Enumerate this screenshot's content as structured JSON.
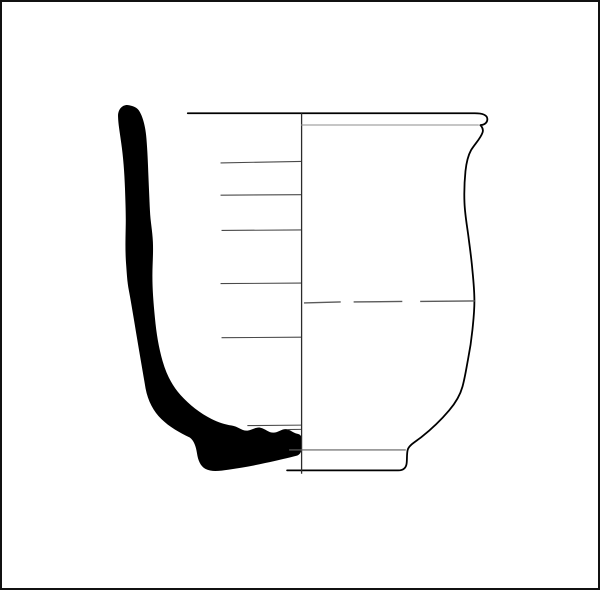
{
  "figure": {
    "type": "archaeological-vessel-profile-drawing",
    "description": "Technical ceramic illustration: solid black half-section on the left, exterior elevation of the pot on the right, divided by a vertical center axis. Vessel has a slightly everted rounded rim, gently convex body, and a narrow projecting foot.",
    "background_color": "#ffffff",
    "frame_color": "#111111",
    "ink_color": "#000000",
    "guide_line_color": "#4a4a4a",
    "dashed_line_color": "#5a5a5a"
  },
  "drawing": {
    "viewbox": "0 0 600 590",
    "section_profile_path": "M128,104 C122,102.5 116.5,107.5 116.8,115.5 C117,123 118.6,131.5 120,142 C122,156 123.2,171 123.8,188 C124.3,203 124.8,214 124.5,227 C124.2,242 124,252 125,265 C125.8,276 126.2,283 127.8,291 C130.4,305 133,321 136,339 C139,357 141.5,371 144.5,389 C147,402 152.5,412 160.5,420 C168.5,427.8 178.5,433.5 189,438.5 C193.2,441.5 195.3,447.5 196.3,454.5 C197.3,461.5 199.8,467.5 205,470.2 C211,473.3 218.5,472.3 228.5,470.8 C240.5,469 252.5,467 265,464.2 C277,461.5 289,458.7 296.5,456.8 C299.8,455.9 301.5,453.2 301.5,449.5 L301.5,439.5 C301.5,436.8 300.2,435.2 297.2,434.7 C293.2,434.1 290.2,430.6 286.2,430.1 C281.7,429.6 278.2,433.6 273.2,433.6 C268.2,433.6 265.2,429.6 260.2,428.6 C255.2,427.6 251.2,431.6 246.2,431.6 C241.2,431.6 237.2,427.3 231.2,426.4 C224.2,425.3 217.7,423.2 210.7,419.7 C199.7,414.2 188.7,405.7 179.7,395.7 C171.7,386.7 165.7,375.7 161.7,361.7 C157.7,347.7 155.4,333.7 153.9,317.7 C152.4,301.7 151.4,289.7 151.4,275.7 C151.4,263.7 152.4,253.7 151.9,241.7 C151.4,229.7 149.4,221.7 148.9,209.7 C148.4,197.7 147.9,187.7 147.4,175.7 C146.9,161.7 146.4,149.7 145.4,137.7 C144.6,127.7 142.6,117.5 138.6,110.5 C136,106 132,104.8 128,104 Z",
    "exterior_outline_path": "M187,112 L476,112 C483,112 488.2,113.2 488.6,117.5 C489,121.2 486,123.6 481.6,124 C483.8,126.2 484.8,128.4 483.8,131.4 C481.8,137.4 476.4,142.4 472.2,149.2 C469.2,154.6 467.6,161.2 466.6,170.2 C465.6,180.2 465.1,190.2 465.6,202.2 C466.1,214.2 468,224.2 469.6,236.2 C471.1,248.2 472.6,258.2 473.6,270.2 C474.6,280.2 475.6,290.2 475.6,301.2 C475.6,312.2 474.6,320.2 473.6,330.2 C472.6,340.2 471.1,350.2 469.1,360.2 C467.4,369.2 466.1,378.2 463.6,387.2 C461.1,396.2 456.1,404.2 450.1,411.2 C442.1,420.7 432.1,430.2 422.1,438.2 C416.1,442.9 409.6,446.2 408.4,451 C407.4,455 407.9,460 407.4,464.2 C406.9,469.2 403.9,471.6 398.9,471.6 L287,471.6",
    "center_axis_path": "M301.6,112 L301.6,475",
    "interior_surface_lines_path": "M220,162 L301,160.5 M220,194.5 L301,194 M221,230 L301,229.5 M220,283.5 L301,283 M221,338 L301,337.5 M247,426.5 L301,426 M287,430.5 L301,430.3",
    "rim_interior_line_path": "M301,123.8 L480,123.8",
    "equator_dashed_path": "M304,303 L341,302 M354,302 L403,301.5 M421,301.5 L476,301",
    "foot_top_line_path": "M289,451 L406.5,451"
  }
}
